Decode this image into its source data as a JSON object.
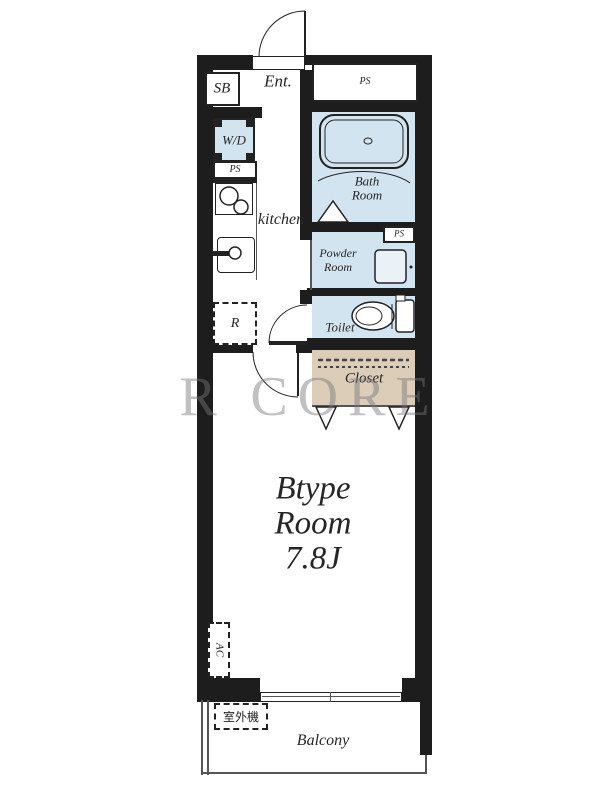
{
  "labels": {
    "entrance": "Ent.",
    "shoe_box": "SB",
    "ps_top": "PS",
    "washer_dryer": "W/D",
    "ps_kitchen": "PS",
    "kitchen": "kitchen",
    "bath_line1": "Bath",
    "bath_line2": "Room",
    "powder_line1": "Powder",
    "powder_line2": "Room",
    "ps_toilet": "PS",
    "toilet": "Toilet",
    "closet": "Closet",
    "refrigerator": "R",
    "room_line1": "Btype",
    "room_line2": "Room",
    "room_line3": "7.8J",
    "ac": "AC",
    "outdoor_unit": "室外機",
    "balcony": "Balcony"
  },
  "watermark": {
    "left_letter": "R",
    "word": "CORE"
  },
  "colors": {
    "wall": "#1d1d1d",
    "wet": "#d2e4ef",
    "closet_fill": "#dbcdb8",
    "watermark": "#787878",
    "line": "#222222"
  }
}
